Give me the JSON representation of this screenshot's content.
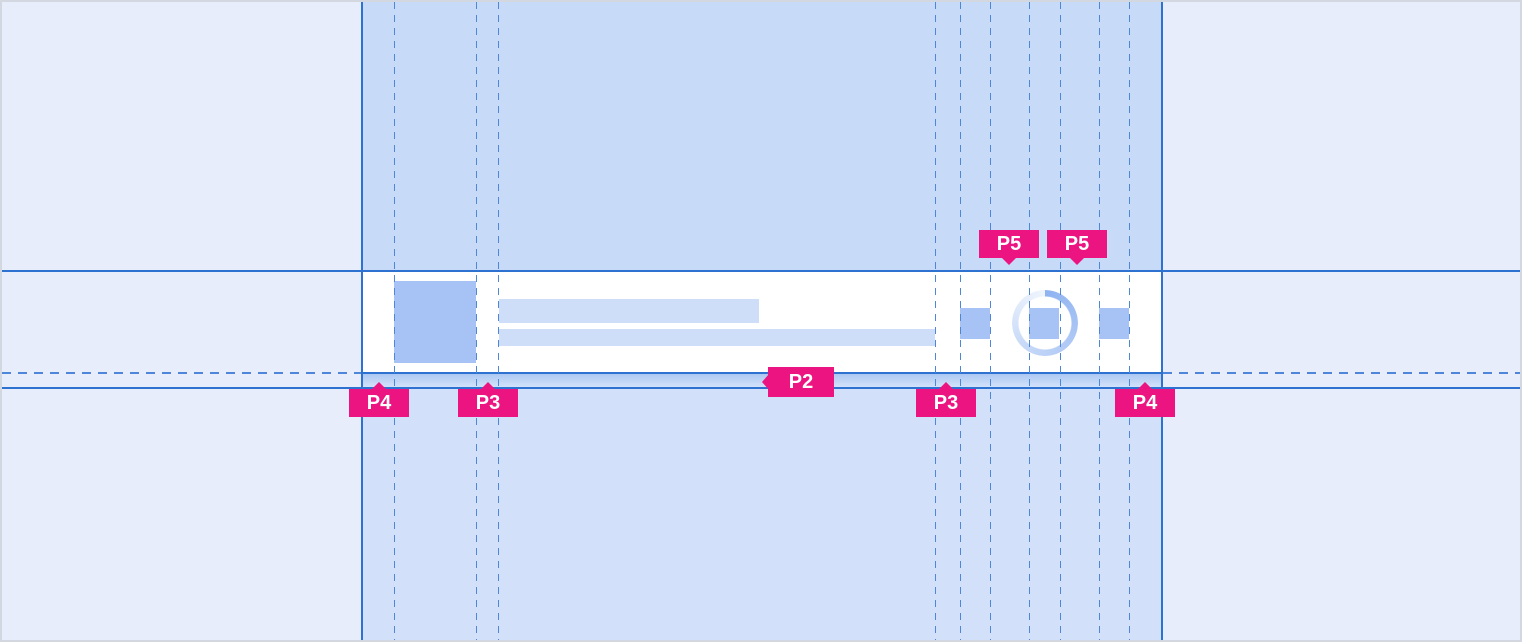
{
  "canvas": {
    "width": 1522,
    "height": 642
  },
  "annotations": {
    "labels": [
      {
        "id": "p5-left",
        "text": "P5",
        "pointer": "down"
      },
      {
        "id": "p5-right",
        "text": "P5",
        "pointer": "down"
      },
      {
        "id": "p2",
        "text": "P2",
        "pointer": "left"
      },
      {
        "id": "p4-left",
        "text": "P4",
        "pointer": "up"
      },
      {
        "id": "p3-left",
        "text": "P3",
        "pointer": "up"
      },
      {
        "id": "p3-right",
        "text": "P3",
        "pointer": "up"
      },
      {
        "id": "p4-right",
        "text": "P4",
        "pointer": "up"
      }
    ],
    "label_background": "#ec1480",
    "label_text_color": "#ffffff"
  },
  "guides": {
    "solid_line_color": "#2e72d1",
    "dashed_line_color": "#4e87da",
    "vertical_solid_x": [
      361,
      1160
    ],
    "vertical_dashed_x": [
      392,
      474,
      496,
      933,
      958,
      988,
      1027,
      1058,
      1097,
      1127
    ],
    "horizontal_solid_y": [
      269,
      371,
      386
    ]
  },
  "component": {
    "kind": "list-item-skeleton",
    "card_background": "#ffffff",
    "placeholder_fill": "#a7c2f4",
    "bar_fill": "#cedef9",
    "padding_highlight_gradient": [
      "#a9c6f2",
      "#d6e4fa"
    ]
  },
  "colors": {
    "page_background": "#e8edfb",
    "band_background_upper": "#c7daf8",
    "band_background_lower": "#d2e1f9"
  }
}
